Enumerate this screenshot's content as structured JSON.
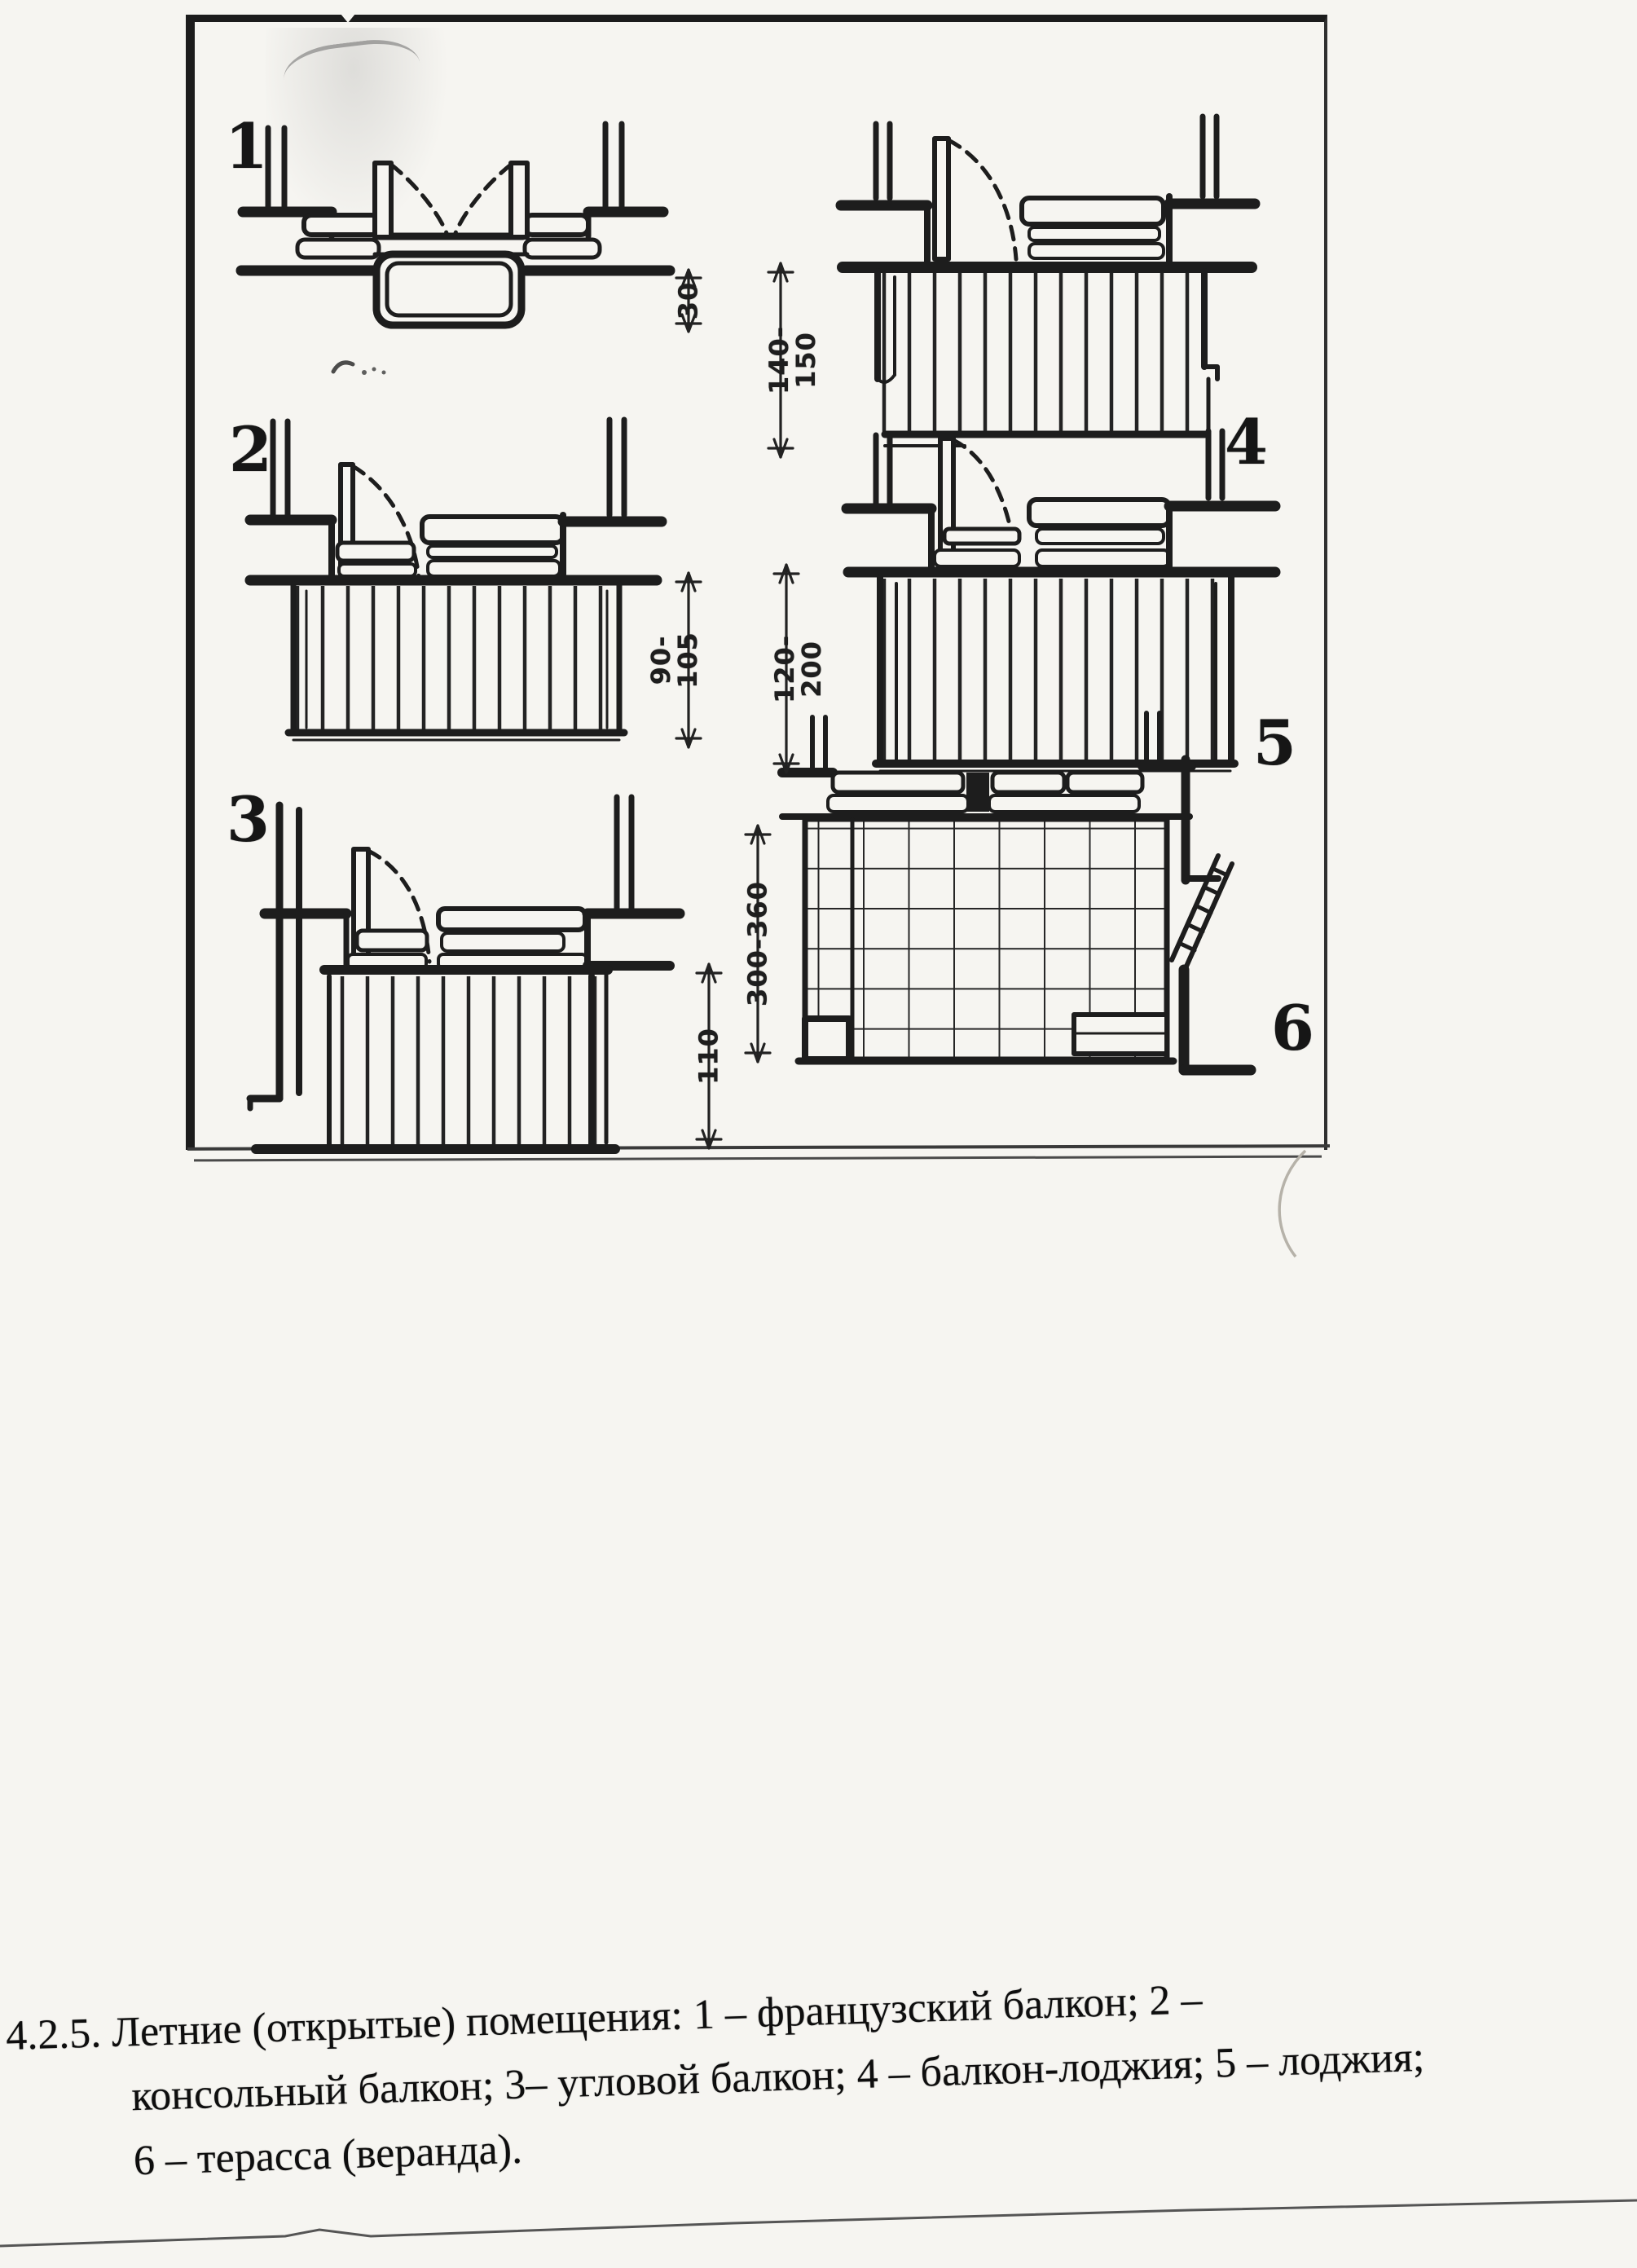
{
  "page": {
    "paper_color": "#f6f5f1",
    "ink_color": "#1d1d1d"
  },
  "figure": {
    "diagrams": [
      {
        "label": "1",
        "dim_lines": [
          "30"
        ]
      },
      {
        "label": "2",
        "dim_lines": [
          "90-",
          "105"
        ]
      },
      {
        "label": "3",
        "dim_lines": [
          "110"
        ]
      },
      {
        "label": "4",
        "dim_lines": [
          "140-",
          "150"
        ]
      },
      {
        "label": "5",
        "dim_lines": [
          "120-",
          "200"
        ]
      },
      {
        "label": "6",
        "dim_lines": [
          "300-360"
        ]
      }
    ]
  },
  "caption": {
    "lines": [
      "4.2.5. Летние (открытые) помещения: 1 – французский балкон; 2 –",
      "консольный балкон; 3– угловой балкон; 4 – балкон-лоджия; 5 – лоджия;",
      "6 – терасса (веранда)."
    ]
  }
}
